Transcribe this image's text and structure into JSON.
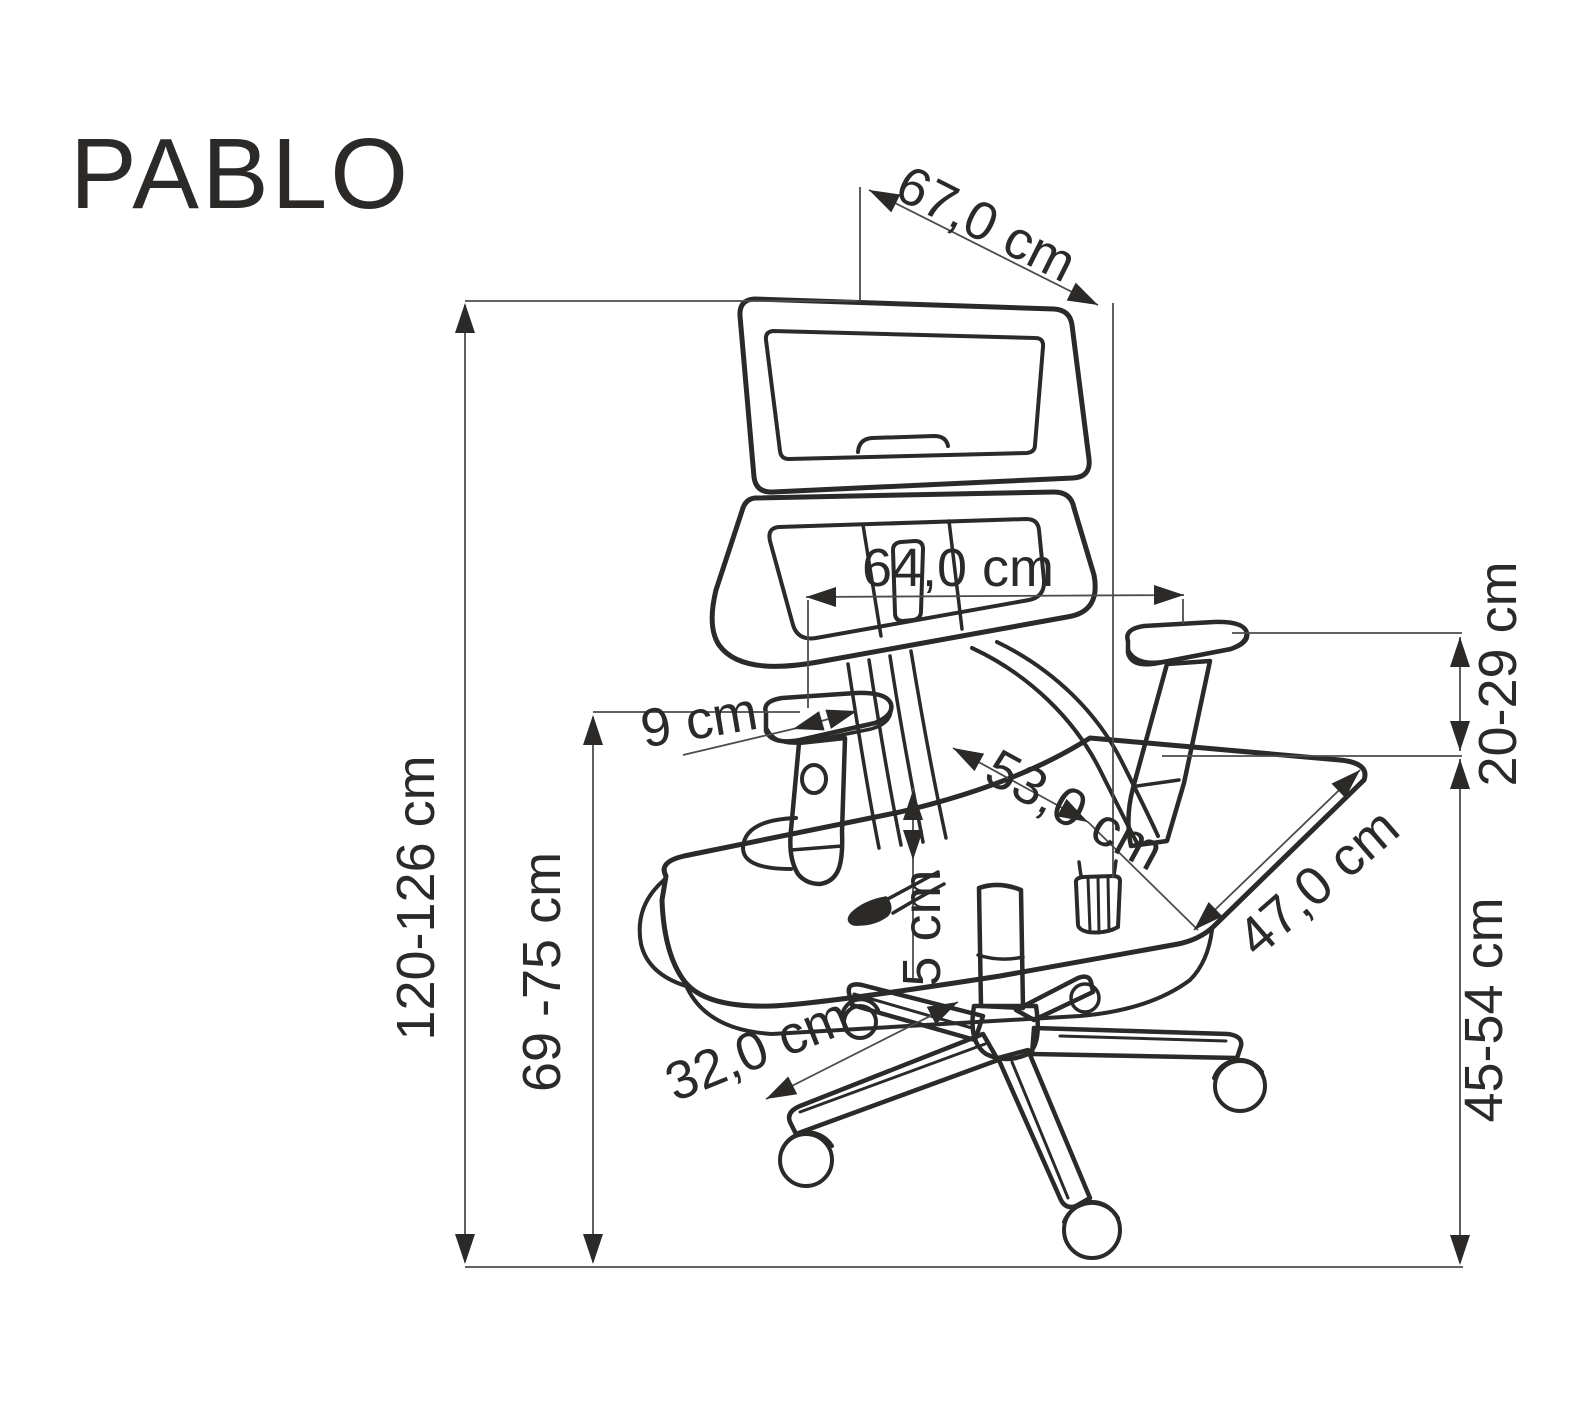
{
  "title": "PABLO",
  "dimensions": {
    "top_depth": "67,0 cm",
    "backrest_width": "64,0 cm",
    "armrest_pad_width": "9 cm",
    "armrest_height_above_seat": "20-29 cm",
    "seat_depth": "53,0 cm",
    "seat_width": "47,0 cm",
    "seat_cushion_thickness": "5 cm",
    "base_leg_length": "32,0 cm",
    "floor_to_armrest_height": "69 -75 cm",
    "total_height": "120-126 cm",
    "seat_height": "45-54 cm"
  },
  "colors": {
    "line": "#2b2a29",
    "dimension_line": "#4c4c4a",
    "background": "#ffffff"
  }
}
